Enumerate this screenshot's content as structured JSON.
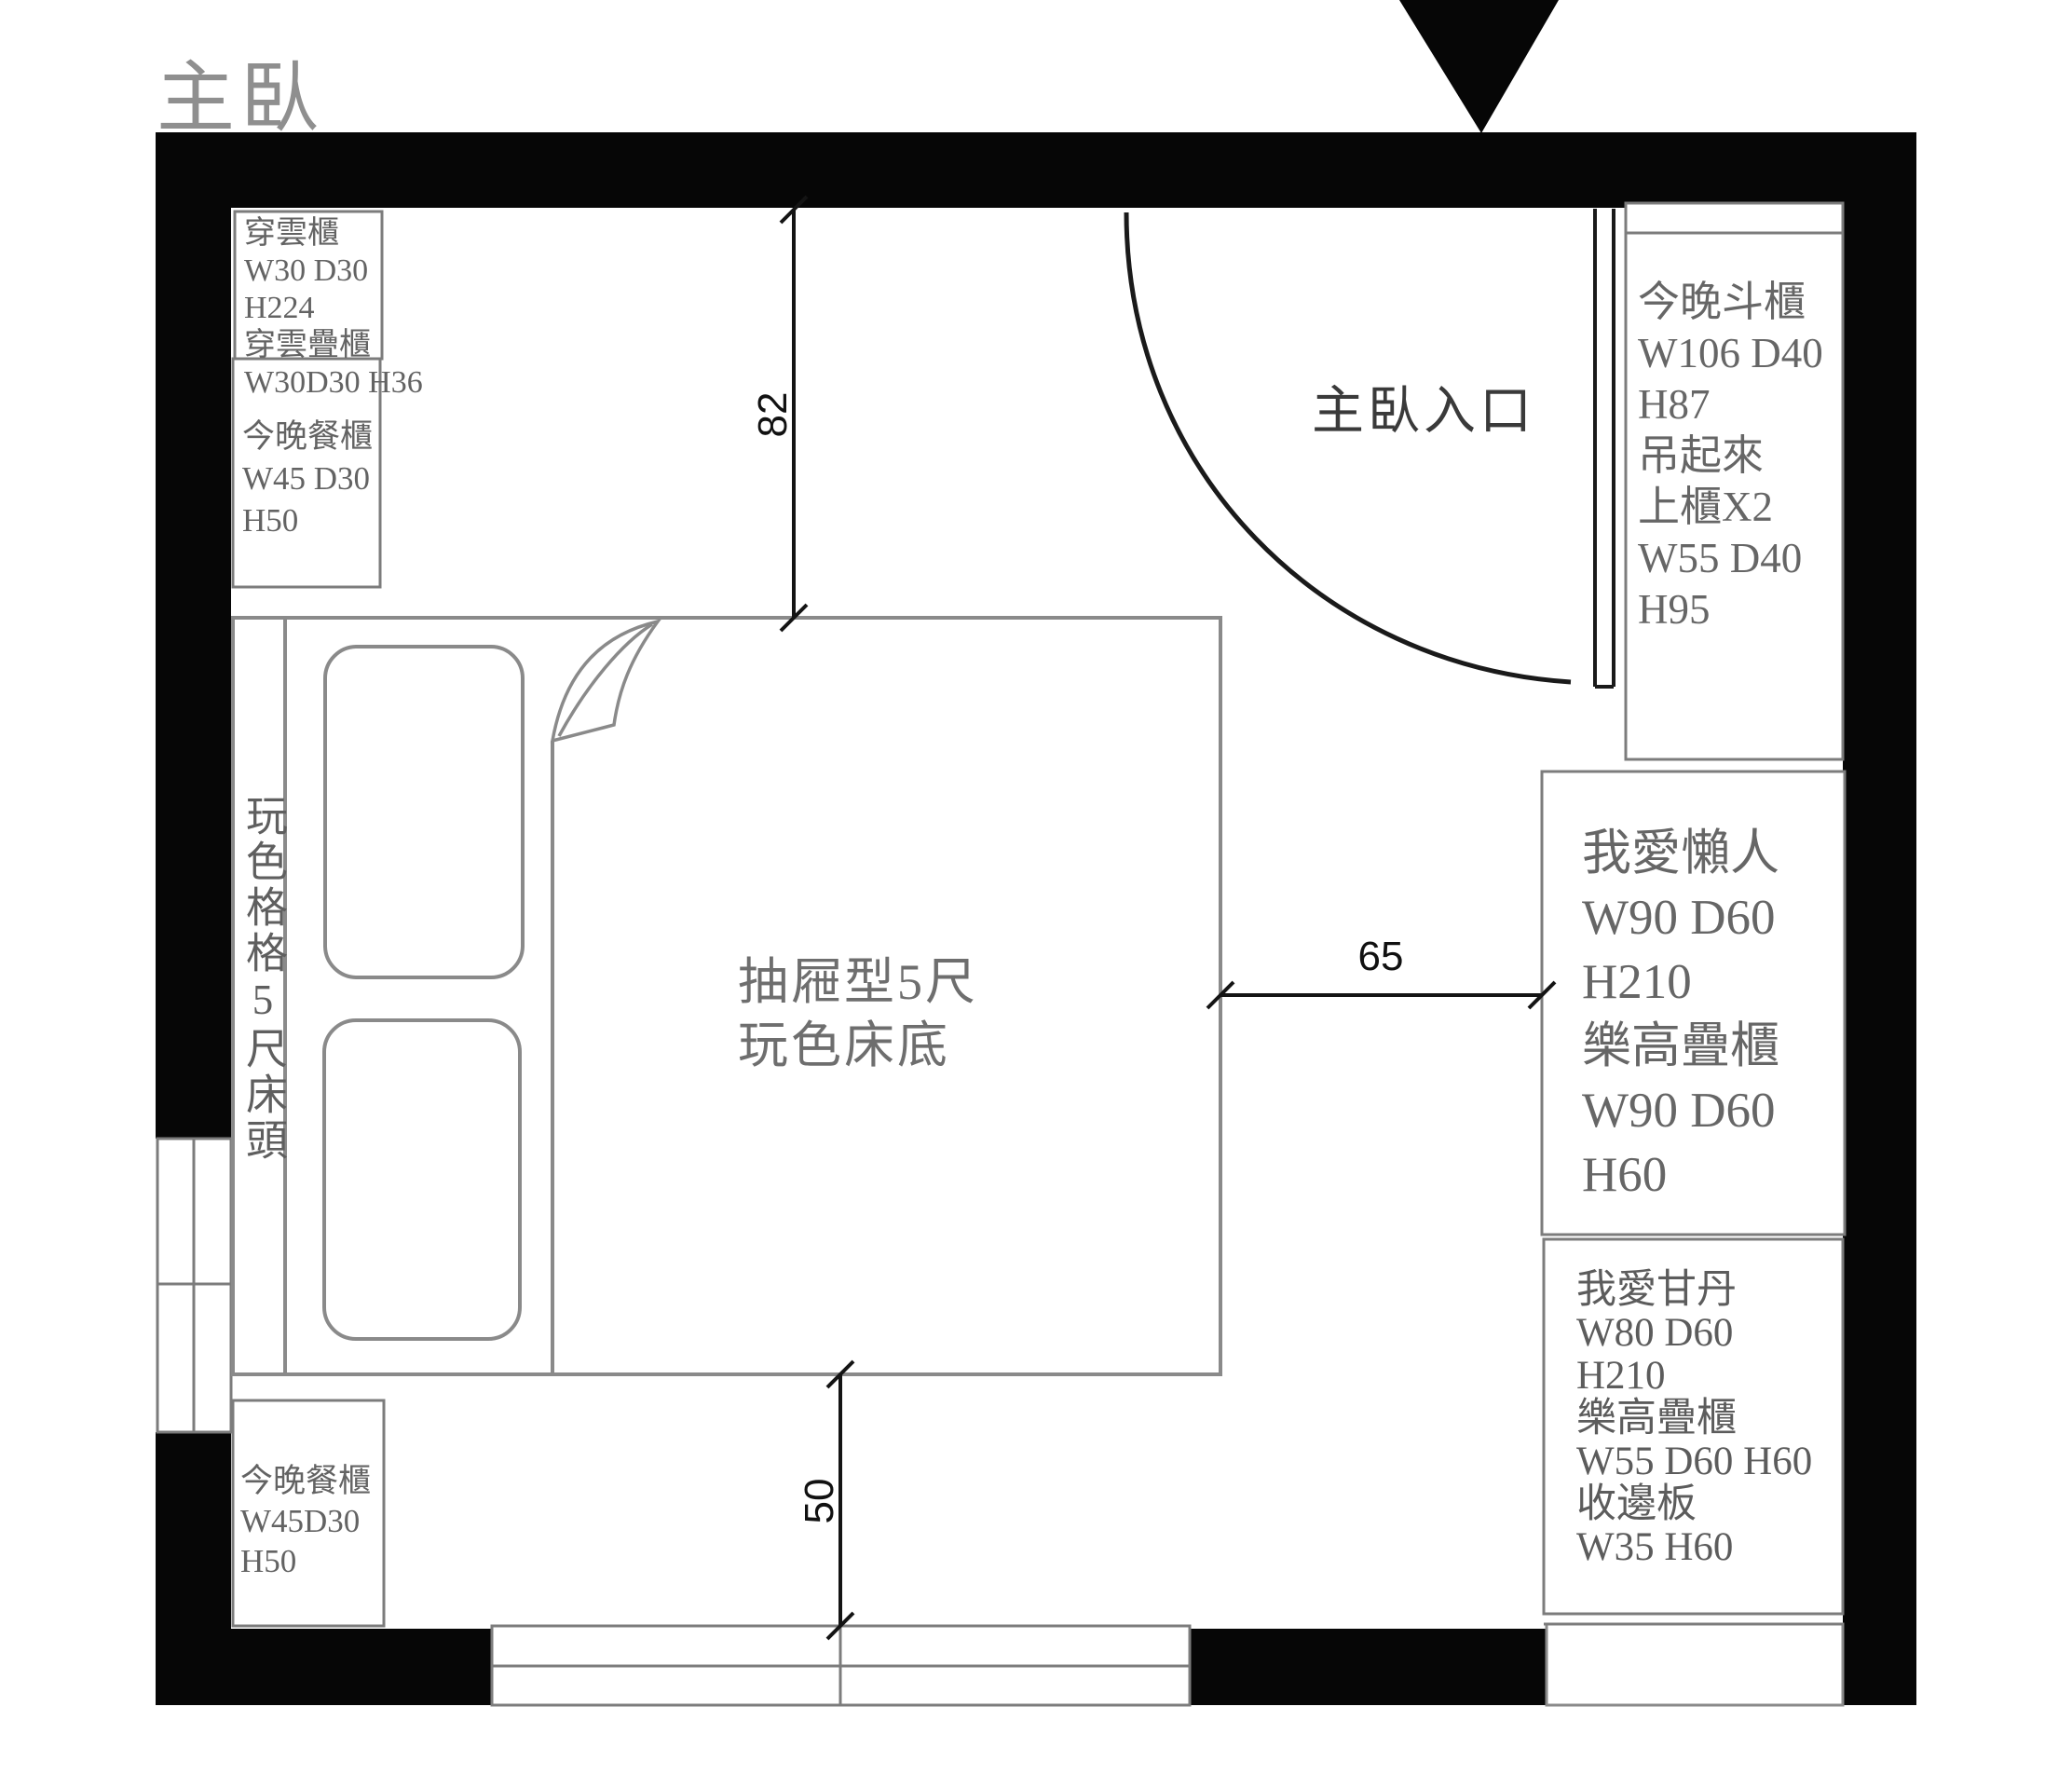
{
  "title": "主臥",
  "entrance": {
    "label": "主臥入口"
  },
  "dimensions": {
    "top_offset": "82",
    "right_offset": "65",
    "bottom_offset": "50"
  },
  "furniture": {
    "cabinet_top_left_upper": {
      "lines": [
        "穿雲櫃",
        "W30 D30",
        "H224",
        "穿雲疊櫃",
        "W30D30 H36"
      ]
    },
    "cabinet_top_left_lower": {
      "lines": [
        "今晚餐櫃",
        "W45 D30",
        "H50"
      ]
    },
    "chest_right": {
      "lines": [
        "今晚斗櫃",
        "W106 D40",
        "H87",
        "吊起來",
        "上櫃X2",
        "W55 D40",
        "H95"
      ]
    },
    "wardrobe_lazy": {
      "lines": [
        "我愛懶人",
        "W90 D60",
        "H210",
        "樂高疊櫃",
        "W90 D60",
        "H60"
      ]
    },
    "wardrobe_gandan": {
      "lines": [
        "我愛甘丹",
        "W80 D60",
        "H210",
        "樂高疊櫃",
        "W55 D60 H60",
        "收邊板",
        "W35  H60"
      ]
    },
    "cabinet_bottom_left": {
      "lines": [
        "今晚餐櫃",
        "W45D30",
        "H50"
      ]
    },
    "bed": {
      "label_lines": [
        "抽屜型5尺",
        "玩色床底"
      ],
      "headboard_label": "玩色格格5尺床頭"
    }
  },
  "colors": {
    "wall": "#060606",
    "outline_gray": "#7c7c7c",
    "bed_gray": "#8a8a8a",
    "dimension": "#141414",
    "text_gray": "#5f5f5f"
  }
}
